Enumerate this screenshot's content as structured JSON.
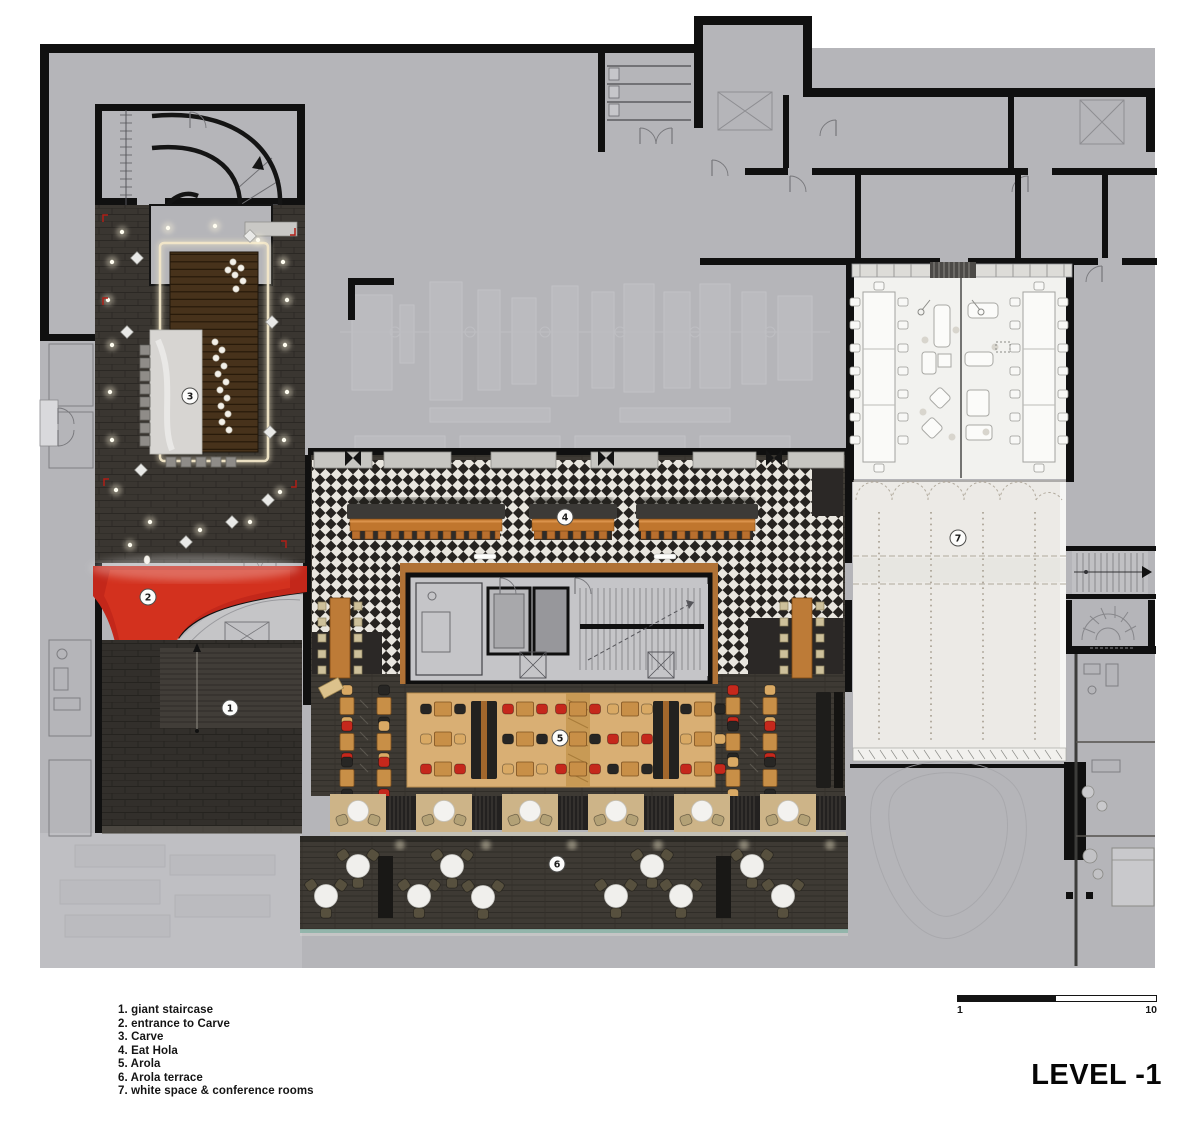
{
  "title": "LEVEL -1",
  "legend": {
    "items": [
      "1. giant staircase",
      "2. entrance to Carve",
      "3. Carve",
      "4. Eat Hola",
      "5. Arola",
      "6. Arola terrace",
      "7. white space & conference rooms"
    ]
  },
  "scale_bar": {
    "start_label": "1",
    "end_label": "10"
  },
  "markers": [
    {
      "label": "1",
      "area": "giant staircase"
    },
    {
      "label": "2",
      "area": "entrance to Carve"
    },
    {
      "label": "3",
      "area": "Carve"
    },
    {
      "label": "4",
      "area": "Eat Hola"
    },
    {
      "label": "5",
      "area": "Arola"
    },
    {
      "label": "6",
      "area": "Arola terrace"
    },
    {
      "label": "7",
      "area": "white space & conference rooms"
    }
  ],
  "colors": {
    "plan_gray": "#b5b5b9",
    "wall_black": "#101010",
    "entrance_red": "#cf2a1b",
    "checker_dark": "#262320",
    "checker_light": "#e9e6df",
    "bar_wood": "#c0762e",
    "platform_wood": "#d9af74",
    "chair_red": "#c5281c",
    "chair_tan": "#d9a964",
    "terrace_teal": "#8fb5aa",
    "white_space": "#eceae6"
  }
}
